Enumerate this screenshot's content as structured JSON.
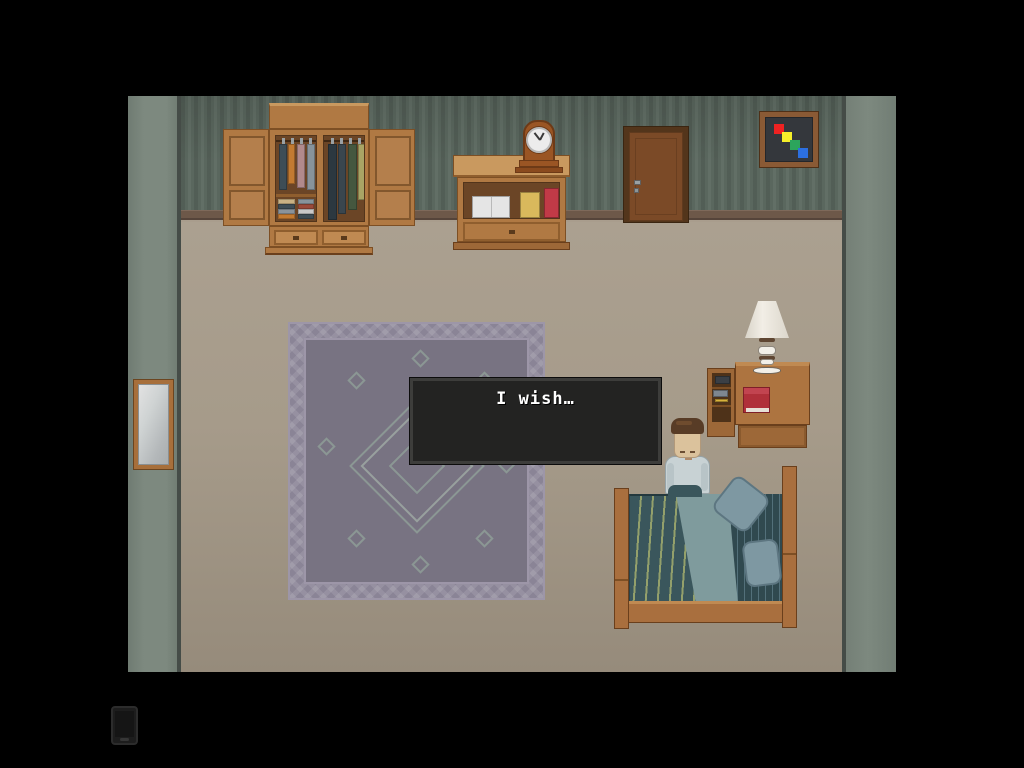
{
  "dialog": {
    "text": "I wish…"
  },
  "art": {
    "squares": [
      "#ee2222",
      "#f5ef2a",
      "#2ca55c",
      "#2c6fe0"
    ]
  },
  "wardrobe": {
    "hanging_short": [
      "#3e4d56",
      "#c27a31",
      "#b18a8c",
      "#87939b"
    ],
    "hanging_long": [
      "#2c3840",
      "#3a464e",
      "#45573f",
      "#a9a465"
    ],
    "folded_left": [
      "#c9b184",
      "#3e4d56",
      "#8a939a",
      "#c27a31"
    ],
    "folded_right": [
      "#87939b",
      "#9a4a3a",
      "#c9c9c9",
      "#3e4d56"
    ]
  },
  "nightstand_items": {
    "dark_book": "#3a3f45",
    "gray_book": "#7e8790",
    "pencil": "#d9b23c"
  },
  "palette": {
    "backdrop": "#000000",
    "wall_back": "#5c6960",
    "wall_side": "#7d897f",
    "floor": "#a99d8d",
    "baseboard": "#6d5849",
    "wood": "#b07943",
    "door": "#7b4a27",
    "blanket": "#3a565c",
    "blanket_stripe": "#93a06b",
    "sheet": "#7f9b9d",
    "pillow": "#7e98a2",
    "rug": "#8a8496",
    "rug_field": "#787382",
    "skin": "#dbc29c",
    "hair": "#583c26",
    "shirt": "#c8d2d4",
    "clock_body": "#9a5524",
    "book_red": "#b0303a",
    "dialog_bg": "#232322",
    "dialog_border": "#3d3d3b",
    "dialog_text": "#ffffff"
  }
}
